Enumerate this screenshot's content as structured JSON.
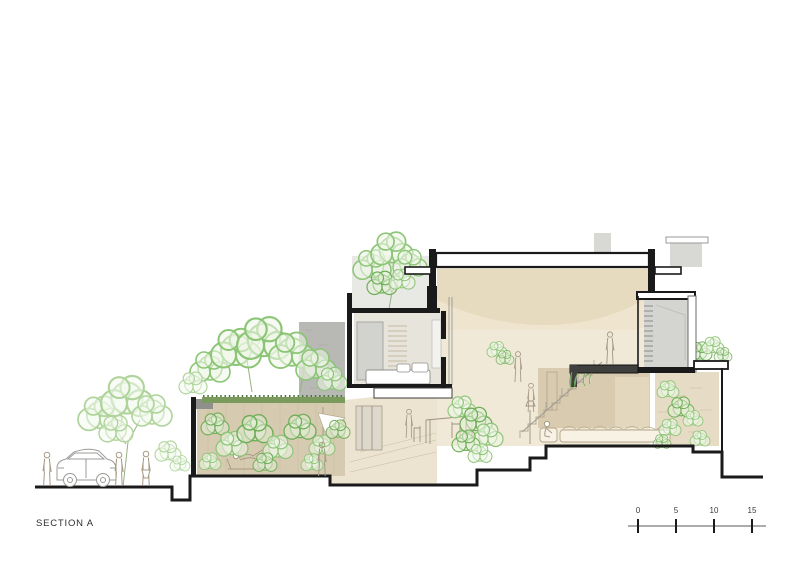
{
  "drawing": {
    "title": "SECTION A",
    "type_note": "architectural cross-section illustration"
  },
  "scale_bar": {
    "labels": [
      "0",
      "5",
      "10",
      "15"
    ]
  },
  "palette": {
    "foliage_green": "#8cc576",
    "foliage_light": "#aed49a",
    "hedge_green": "#5d8c49",
    "interior_cream": "#f2ecdb",
    "ceiling_tan": "#e6dabf",
    "wall_tan": "#d6cab1",
    "concrete_gray": "#b8b8b5",
    "cut_black": "#1a1a1a"
  }
}
